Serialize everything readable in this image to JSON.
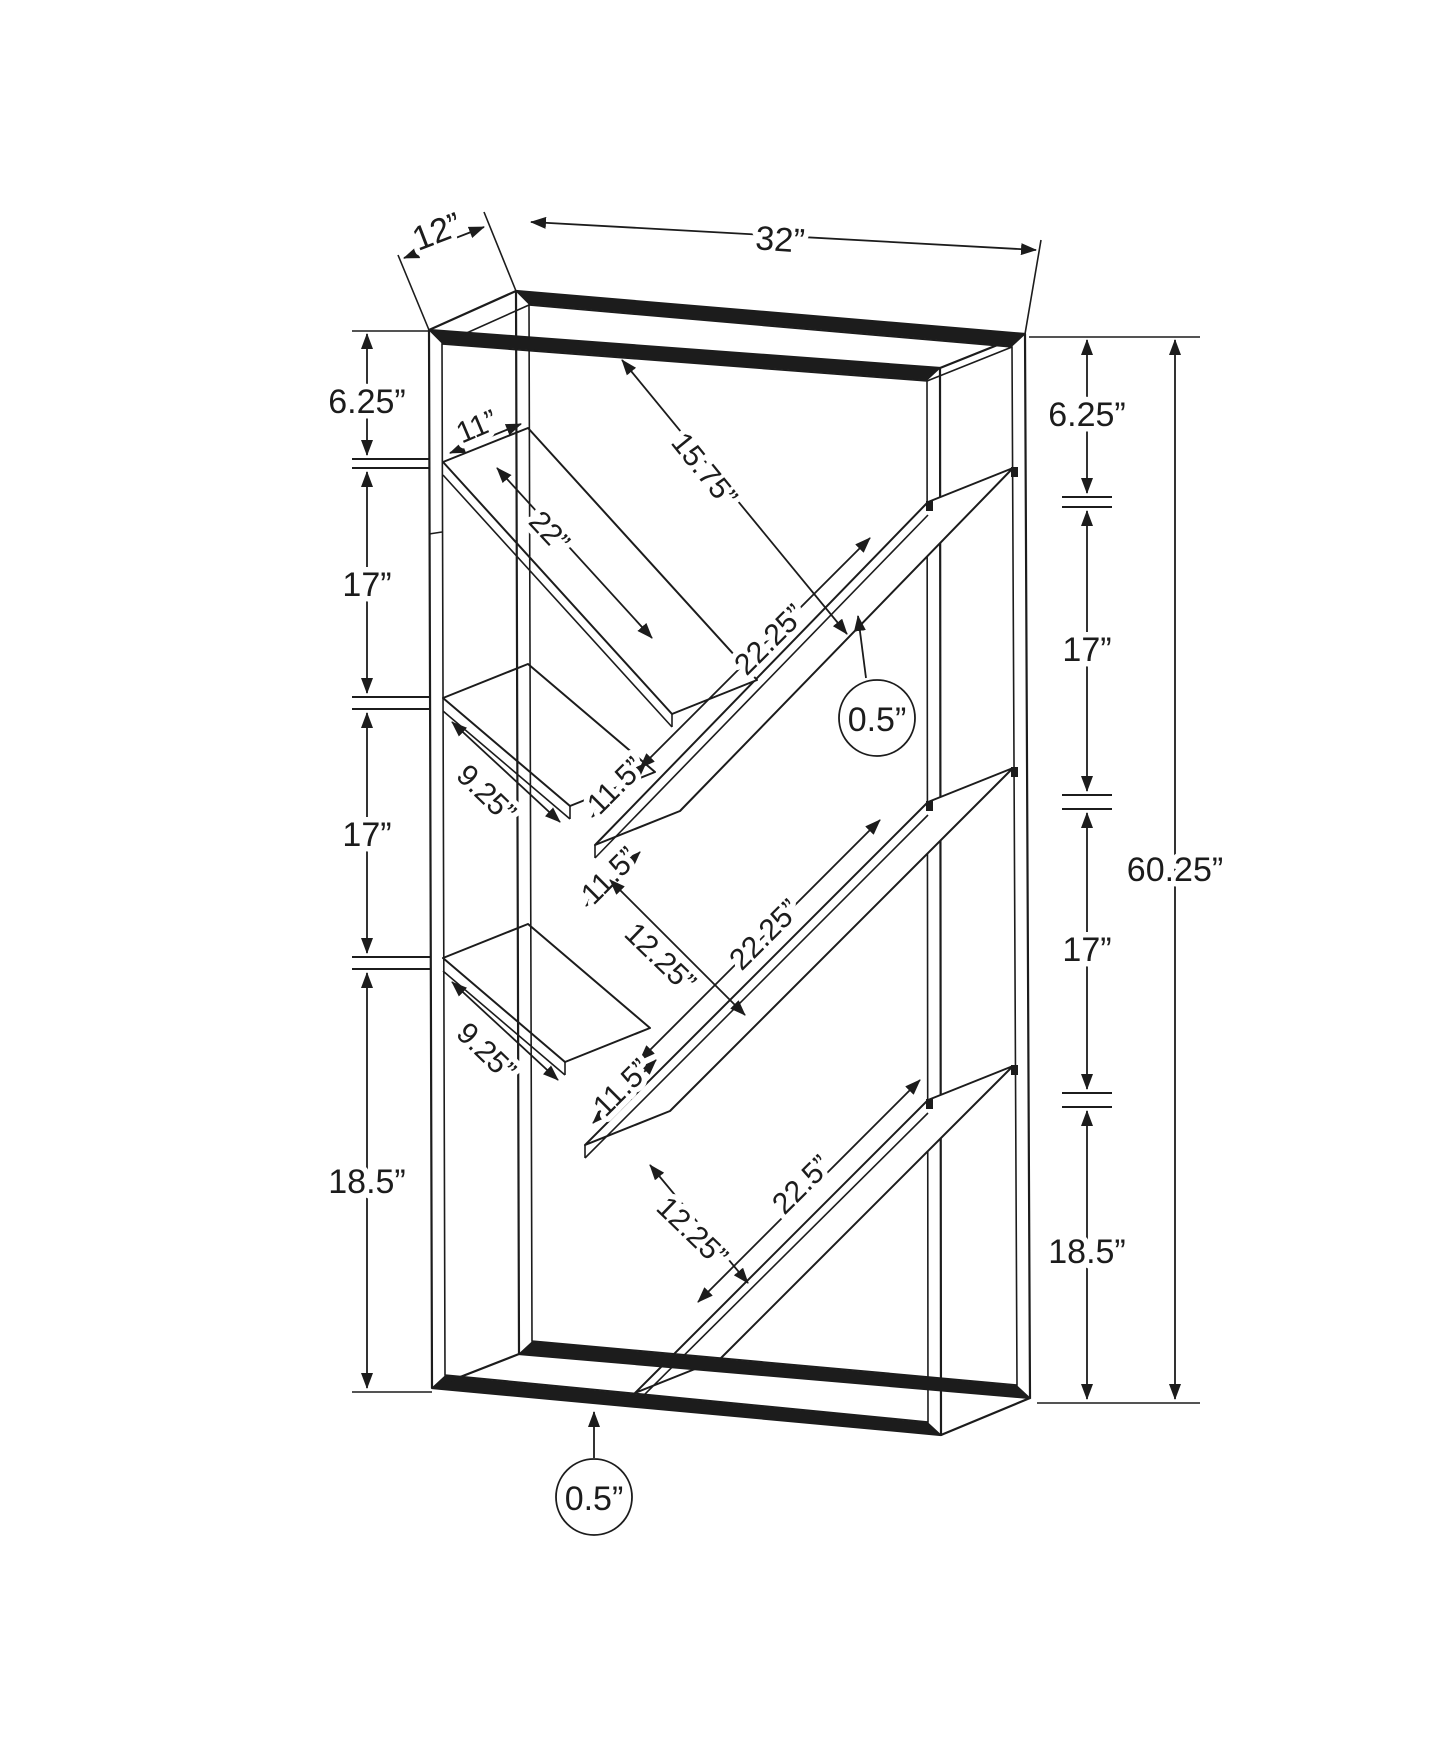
{
  "colors": {
    "line": "#1c1c1c",
    "background": "#ffffff"
  },
  "drawing": {
    "kind": "furniture dimension line drawing",
    "subject": "bookcase with v-shaped shelves, perspective view with dimension callouts"
  },
  "labels": {
    "depth": "12”",
    "width": "32”",
    "left_chain_top": "6.25”",
    "left_chain_second": "17”",
    "left_chain_third": "17”",
    "left_chain_bottom": "18.5”",
    "right_chain_top": "6.25”",
    "right_chain_second": "17”",
    "right_chain_third": "17”",
    "right_chain_bottom": "18.5”",
    "overall_height": "60.25”",
    "shelf_edge_width": "11”",
    "top_opening_diagonal": "15.75”",
    "upper_left_plank": "22”",
    "upper_right_plank": "22.25”",
    "middle_right_plank": "22.25”",
    "lower_right_plank": "22.5”",
    "middle_short_plank": "9.25”",
    "lower_short_plank": "9.25”",
    "slot_upper": "11.5”",
    "slot_middle": "11.5”",
    "slot_lower": "11.5”",
    "bay_upper": "12.25”",
    "bay_lower": "12.25”",
    "shelf_thickness": "0.5”",
    "frame_thickness": "0.5”"
  }
}
